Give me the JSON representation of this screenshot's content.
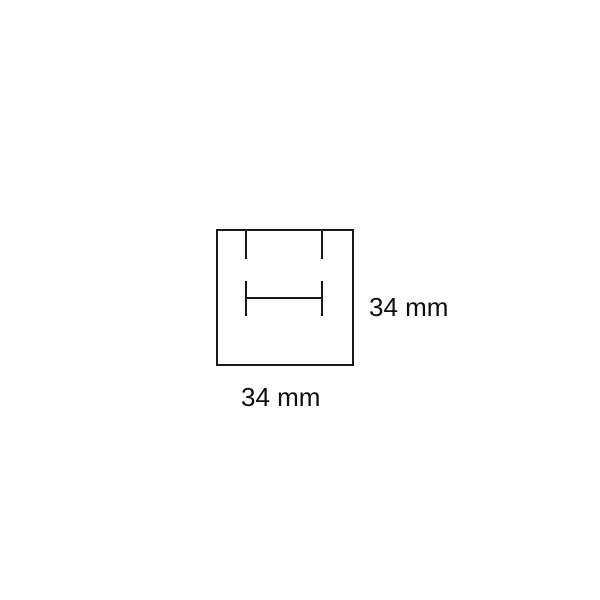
{
  "diagram": {
    "box": {
      "width_label": "34 mm",
      "height_label": "34 mm"
    },
    "colors": {
      "line": "#1a1a1a",
      "text": "#0d0d0d",
      "background": "#ffffff"
    }
  }
}
